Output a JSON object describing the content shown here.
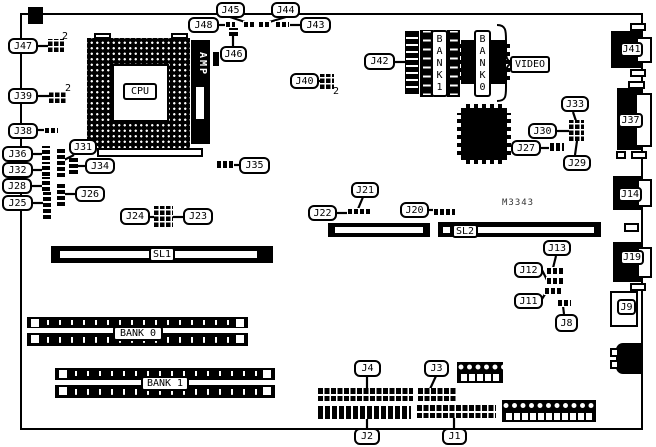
{
  "diagram": {
    "board_model": "M3343",
    "cpu_label": "CPU",
    "regulator_label": "AMP",
    "video_label": "VIDEO",
    "video_bank0_label": "BANK0",
    "video_bank1_label": "BANK1",
    "slot1_label": "SL1",
    "slot2_label": "SL2",
    "mem_bank0_label": "BANK 0",
    "mem_bank1_label": "BANK 1",
    "annotations": {
      "j47_pin": "2",
      "j39_pin": "2",
      "j40_pin": "2"
    },
    "callouts": {
      "j1": "J1",
      "j2": "J2",
      "j3": "J3",
      "j4": "J4",
      "j8": "J8",
      "j9": "J9",
      "j11": "J11",
      "j12": "J12",
      "j13": "J13",
      "j14": "J14",
      "j19": "J19",
      "j20": "J20",
      "j21": "J21",
      "j22": "J22",
      "j23": "J23",
      "j24": "J24",
      "j25": "J25",
      "j26": "J26",
      "j27": "J27",
      "j28": "J28",
      "j29": "J29",
      "j30": "J30",
      "j31": "J31",
      "j32": "J32",
      "j33": "J33",
      "j34": "J34",
      "j35": "J35",
      "j36": "J36",
      "j37": "J37",
      "j38": "J38",
      "j39": "J39",
      "j40": "J40",
      "j41": "J41",
      "j42": "J42",
      "j43": "J43",
      "j44": "J44",
      "j45": "J45",
      "j46": "J46",
      "j47": "J47",
      "j48": "J48"
    }
  }
}
